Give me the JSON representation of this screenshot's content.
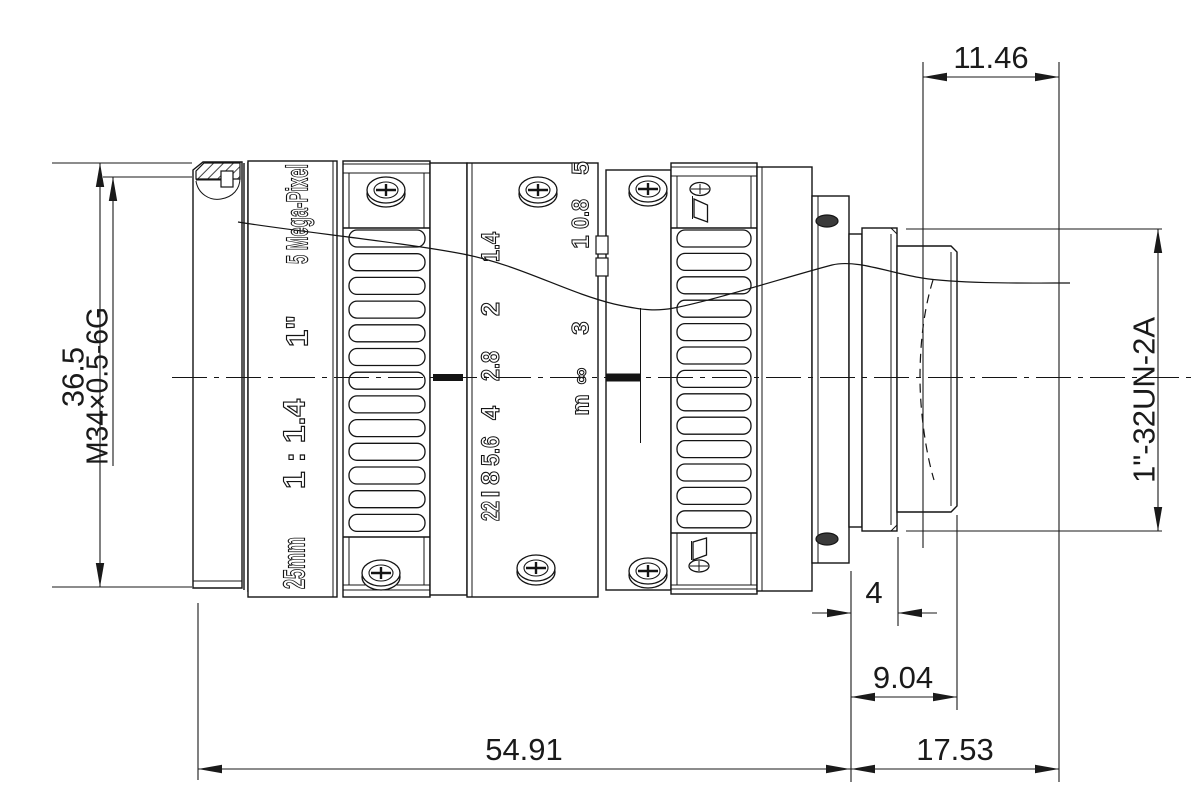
{
  "drawing": {
    "dimensions": {
      "overall_diameter": "36.5",
      "front_thread": "M34×0.5-6G",
      "rear_protrusion": "11.46",
      "mount_thread": "1\"-32UN-2A",
      "flange_width": "4",
      "rear_section": "9.04",
      "body_length": "54.91",
      "mount_length": "17.53"
    },
    "barrel_labels": {
      "resolution": "5 Mega-Pixel",
      "format": "1\"",
      "aperture_ratio": "1 : 1.4",
      "focal_length": "25mm"
    },
    "aperture_scale": {
      "labels": [
        "22",
        "I",
        "8",
        "5.6",
        "4",
        "2.8",
        "2",
        "1.4"
      ]
    },
    "distance_scale": {
      "labels": [
        "m",
        "∞",
        "3",
        "1",
        "0.8",
        "5"
      ]
    },
    "colors": {
      "line": "#141414",
      "background": "#ffffff"
    }
  }
}
